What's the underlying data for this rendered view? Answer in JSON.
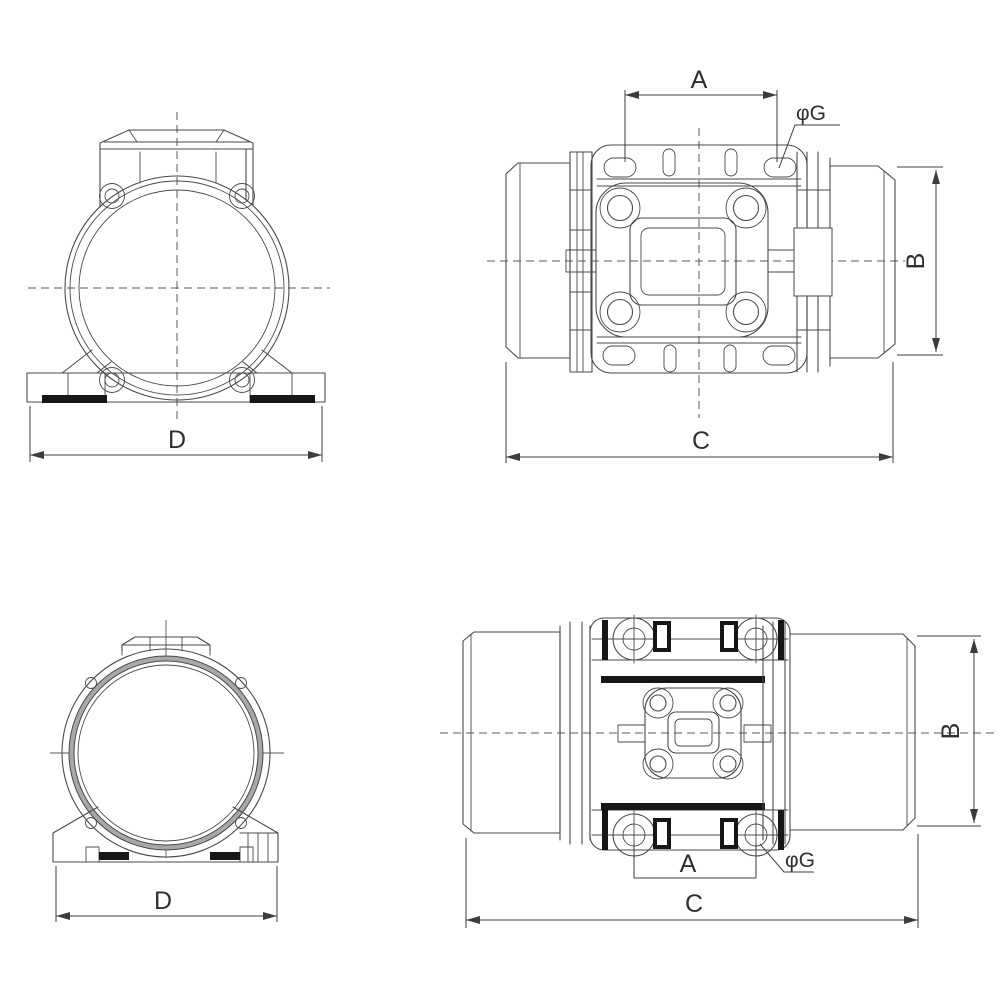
{
  "colors": {
    "background": "#ffffff",
    "line": "#4a4a4a",
    "dimension": "#3c3c3c",
    "black_fill": "#161616",
    "ring_gray": "#a8a8a8"
  },
  "labels": {
    "top_front": {
      "d": "D"
    },
    "top_side": {
      "a": "A",
      "phi_g": "φG",
      "b": "B",
      "c": "C"
    },
    "bottom_front": {
      "d": "D"
    },
    "bottom_side": {
      "a": "A",
      "phi_g": "φG",
      "b": "B",
      "c": "C"
    }
  }
}
